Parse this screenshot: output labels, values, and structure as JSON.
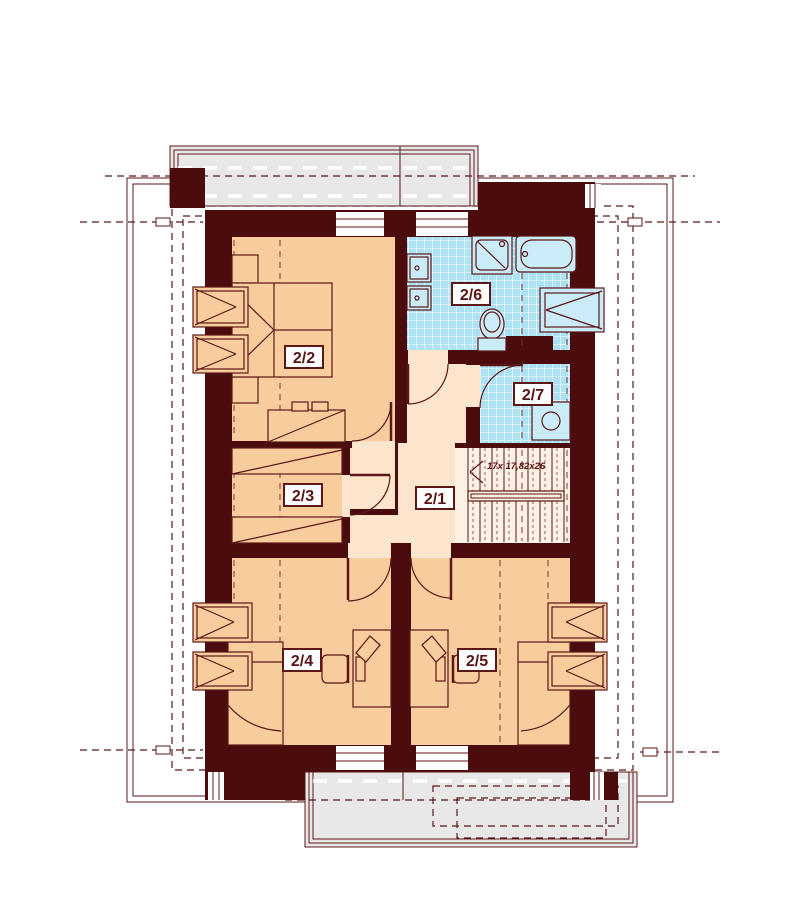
{
  "rooms": {
    "hall": {
      "label": "2/1"
    },
    "bedroom_top": {
      "label": "2/2"
    },
    "wardrobe_room": {
      "label": "2/3"
    },
    "bedroom_left": {
      "label": "2/4"
    },
    "bedroom_right": {
      "label": "2/5"
    },
    "bathroom": {
      "label": "2/6"
    },
    "laundry": {
      "label": "2/7"
    }
  },
  "stairs": {
    "annotation": "17x 17,82x26"
  },
  "colors": {
    "paper": "#ffffff",
    "wall": "#4a0c0c",
    "line": "#5c1717",
    "knee": "#7b3434",
    "bedroom": "#f8cd9e",
    "hall": "#fbe5cc",
    "stair": "#fdf1e3",
    "tile": "#aee2f2",
    "fixture": "#c9ecf8",
    "balcony": "#e8e8e8",
    "label": "#5a1212"
  }
}
